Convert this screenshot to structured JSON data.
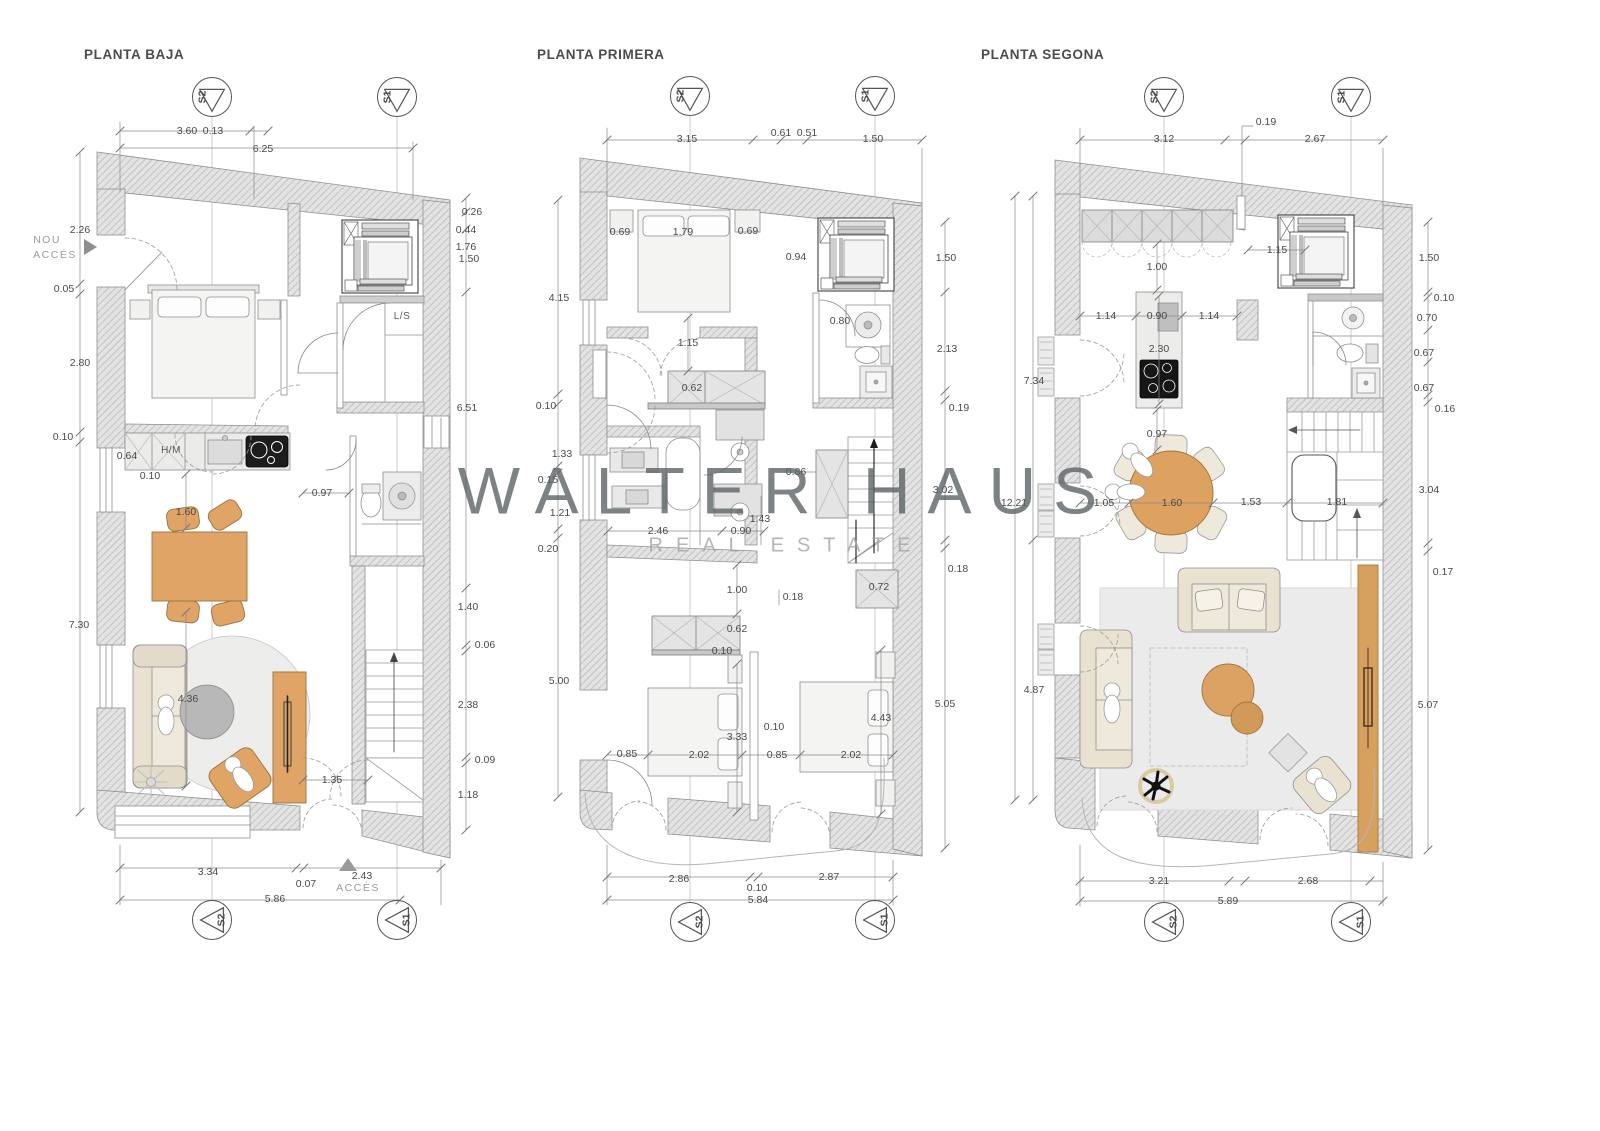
{
  "watermark": {
    "line1": "WALTER HAUS",
    "line2": "REAL ESTATE"
  },
  "plans": [
    {
      "title": "PLANTA BAJA",
      "labels": [
        {
          "t": "3.60",
          "x": 187,
          "y": 131
        },
        {
          "t": "0.13",
          "x": 213,
          "y": 131
        },
        {
          "t": "6.25",
          "x": 263,
          "y": 149
        },
        {
          "t": "2.26",
          "x": 80,
          "y": 230
        },
        {
          "t": "NOU",
          "x": 47,
          "y": 240,
          "c": "muted"
        },
        {
          "t": "ACCÉS",
          "x": 55,
          "y": 255,
          "c": "muted"
        },
        {
          "t": "0.05",
          "x": 64,
          "y": 289
        },
        {
          "t": "2.80",
          "x": 80,
          "y": 363
        },
        {
          "t": "0.10",
          "x": 63,
          "y": 437
        },
        {
          "t": "0.64",
          "x": 127,
          "y": 456
        },
        {
          "t": "H/M",
          "x": 171,
          "y": 451,
          "c": "room"
        },
        {
          "t": "0.10",
          "x": 150,
          "y": 476
        },
        {
          "t": "1.60",
          "x": 186,
          "y": 512
        },
        {
          "t": "0.97",
          "x": 322,
          "y": 493
        },
        {
          "t": "L/S",
          "x": 402,
          "y": 317,
          "c": "room"
        },
        {
          "t": "0.26",
          "x": 472,
          "y": 212
        },
        {
          "t": "0.44",
          "x": 466,
          "y": 230
        },
        {
          "t": "1.76",
          "x": 466,
          "y": 247
        },
        {
          "t": "1.50",
          "x": 469,
          "y": 259
        },
        {
          "t": "6.51",
          "x": 467,
          "y": 408
        },
        {
          "t": "7.30",
          "x": 79,
          "y": 625
        },
        {
          "t": "1.40",
          "x": 468,
          "y": 607
        },
        {
          "t": "0.06",
          "x": 485,
          "y": 645
        },
        {
          "t": "2.38",
          "x": 468,
          "y": 705
        },
        {
          "t": "0.09",
          "x": 485,
          "y": 760
        },
        {
          "t": "1.18",
          "x": 468,
          "y": 795
        },
        {
          "t": "4.36",
          "x": 188,
          "y": 699
        },
        {
          "t": "1.35",
          "x": 332,
          "y": 780
        },
        {
          "t": "3.34",
          "x": 208,
          "y": 872
        },
        {
          "t": "0.07",
          "x": 306,
          "y": 884
        },
        {
          "t": "2.43",
          "x": 362,
          "y": 876
        },
        {
          "t": "ACCÈS",
          "x": 358,
          "y": 888,
          "c": "muted"
        },
        {
          "t": "5.86",
          "x": 275,
          "y": 899
        }
      ]
    },
    {
      "title": "PLANTA PRIMERA",
      "labels": [
        {
          "t": "3.15",
          "x": 687,
          "y": 139
        },
        {
          "t": "0.61",
          "x": 781,
          "y": 133
        },
        {
          "t": "0.51",
          "x": 807,
          "y": 133
        },
        {
          "t": "1.50",
          "x": 873,
          "y": 139
        },
        {
          "t": "0.69",
          "x": 620,
          "y": 232
        },
        {
          "t": "1.79",
          "x": 683,
          "y": 232
        },
        {
          "t": "0.69",
          "x": 748,
          "y": 231
        },
        {
          "t": "0.94",
          "x": 796,
          "y": 257
        },
        {
          "t": "0.80",
          "x": 840,
          "y": 321
        },
        {
          "t": "4.15",
          "x": 559,
          "y": 298
        },
        {
          "t": "1.50",
          "x": 946,
          "y": 258
        },
        {
          "t": "2.13",
          "x": 947,
          "y": 349
        },
        {
          "t": "0.19",
          "x": 959,
          "y": 408
        },
        {
          "t": "3.02",
          "x": 943,
          "y": 490
        },
        {
          "t": "0.18",
          "x": 958,
          "y": 569
        },
        {
          "t": "5.05",
          "x": 945,
          "y": 704
        },
        {
          "t": "1.15",
          "x": 688,
          "y": 343
        },
        {
          "t": "0.62",
          "x": 692,
          "y": 388
        },
        {
          "t": "0.10",
          "x": 546,
          "y": 406
        },
        {
          "t": "1.33",
          "x": 562,
          "y": 454
        },
        {
          "t": "0.15",
          "x": 548,
          "y": 480
        },
        {
          "t": "1.21",
          "x": 560,
          "y": 513
        },
        {
          "t": "0.20",
          "x": 548,
          "y": 549
        },
        {
          "t": "0.86",
          "x": 796,
          "y": 472
        },
        {
          "t": "2.46",
          "x": 658,
          "y": 531
        },
        {
          "t": "1.43",
          "x": 760,
          "y": 519
        },
        {
          "t": "0.90",
          "x": 741,
          "y": 531
        },
        {
          "t": "1.00",
          "x": 737,
          "y": 590
        },
        {
          "t": "0.18",
          "x": 793,
          "y": 597
        },
        {
          "t": "0.72",
          "x": 879,
          "y": 587
        },
        {
          "t": "5.00",
          "x": 559,
          "y": 681
        },
        {
          "t": "0.62",
          "x": 737,
          "y": 629
        },
        {
          "t": "0.10",
          "x": 722,
          "y": 651
        },
        {
          "t": "0.10",
          "x": 774,
          "y": 727
        },
        {
          "t": "3.33",
          "x": 737,
          "y": 737
        },
        {
          "t": "4.43",
          "x": 881,
          "y": 718
        },
        {
          "t": "0.85",
          "x": 627,
          "y": 754
        },
        {
          "t": "2.02",
          "x": 699,
          "y": 755
        },
        {
          "t": "0.85",
          "x": 777,
          "y": 755
        },
        {
          "t": "2.02",
          "x": 851,
          "y": 755
        },
        {
          "t": "2.86",
          "x": 679,
          "y": 879
        },
        {
          "t": "0.10",
          "x": 757,
          "y": 888
        },
        {
          "t": "2.87",
          "x": 829,
          "y": 877
        },
        {
          "t": "5.84",
          "x": 758,
          "y": 900
        }
      ]
    },
    {
      "title": "PLANTA SEGONA",
      "labels": [
        {
          "t": "0.19",
          "x": 1266,
          "y": 122
        },
        {
          "t": "3.12",
          "x": 1164,
          "y": 139
        },
        {
          "t": "2.67",
          "x": 1315,
          "y": 139
        },
        {
          "t": "1.15",
          "x": 1277,
          "y": 250
        },
        {
          "t": "1.00",
          "x": 1157,
          "y": 267
        },
        {
          "t": "1.14",
          "x": 1106,
          "y": 316
        },
        {
          "t": "0.90",
          "x": 1157,
          "y": 316
        },
        {
          "t": "1.14",
          "x": 1209,
          "y": 316
        },
        {
          "t": "2.30",
          "x": 1159,
          "y": 349
        },
        {
          "t": "0.97",
          "x": 1157,
          "y": 434
        },
        {
          "t": "7.34",
          "x": 1034,
          "y": 381
        },
        {
          "t": "12.21",
          "x": 1014,
          "y": 503
        },
        {
          "t": "4.87",
          "x": 1034,
          "y": 690
        },
        {
          "t": "1.05",
          "x": 1104,
          "y": 503
        },
        {
          "t": "1.60",
          "x": 1172,
          "y": 503
        },
        {
          "t": "1.53",
          "x": 1251,
          "y": 502
        },
        {
          "t": "1.81",
          "x": 1337,
          "y": 502
        },
        {
          "t": "1.50",
          "x": 1429,
          "y": 258
        },
        {
          "t": "0.10",
          "x": 1444,
          "y": 298
        },
        {
          "t": "0.70",
          "x": 1427,
          "y": 318
        },
        {
          "t": "0.67",
          "x": 1424,
          "y": 353
        },
        {
          "t": "0.67",
          "x": 1424,
          "y": 388
        },
        {
          "t": "0.16",
          "x": 1445,
          "y": 409
        },
        {
          "t": "3.04",
          "x": 1429,
          "y": 490
        },
        {
          "t": "0.17",
          "x": 1443,
          "y": 572
        },
        {
          "t": "5.07",
          "x": 1428,
          "y": 705
        },
        {
          "t": "3.21",
          "x": 1159,
          "y": 881
        },
        {
          "t": "2.68",
          "x": 1308,
          "y": 881
        },
        {
          "t": "5.89",
          "x": 1228,
          "y": 901
        }
      ]
    }
  ],
  "section_markers": [
    {
      "t": "S2",
      "x": 212,
      "y": 97,
      "d": "down"
    },
    {
      "t": "S1",
      "x": 397,
      "y": 97,
      "d": "down"
    },
    {
      "t": "S2",
      "x": 212,
      "y": 920,
      "d": "up"
    },
    {
      "t": "S1",
      "x": 397,
      "y": 920,
      "d": "up"
    },
    {
      "t": "S2",
      "x": 690,
      "y": 96,
      "d": "down"
    },
    {
      "t": "S1",
      "x": 875,
      "y": 96,
      "d": "down"
    },
    {
      "t": "S2",
      "x": 690,
      "y": 922,
      "d": "up"
    },
    {
      "t": "S1",
      "x": 875,
      "y": 920,
      "d": "up"
    },
    {
      "t": "S2",
      "x": 1164,
      "y": 97,
      "d": "down"
    },
    {
      "t": "S1",
      "x": 1351,
      "y": 97,
      "d": "down"
    },
    {
      "t": "S2",
      "x": 1164,
      "y": 922,
      "d": "up"
    },
    {
      "t": "S1",
      "x": 1351,
      "y": 922,
      "d": "up"
    }
  ]
}
